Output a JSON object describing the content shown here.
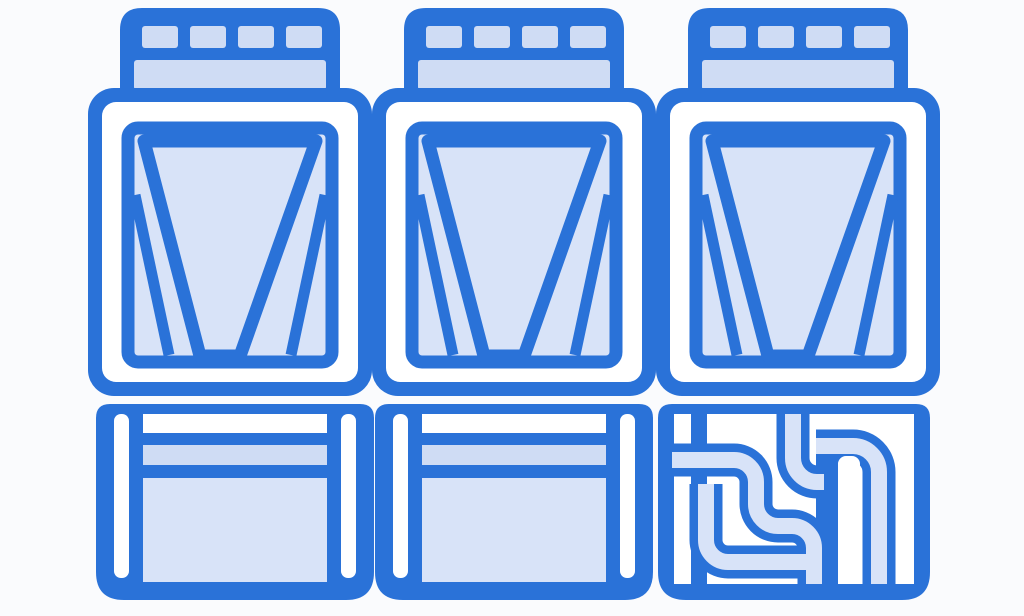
{
  "illustration": {
    "title": "Industrial air-cooled chiller units",
    "description": "Three blue line-art chiller modules with vented top caps, trapezoidal fan shrouds, louvered service bases, and a refrigerant pipe assembly in the base of the right unit",
    "background": "#fafbfd",
    "colors": {
      "outline": "#2a72d8",
      "fill_light": "#cfdcf4",
      "fill_lighter": "#d8e3f8",
      "white": "#ffffff"
    },
    "units": [
      {
        "id": "chiller-unit-1",
        "parts": [
          "vent-cap",
          "fan-panel",
          "service-base"
        ]
      },
      {
        "id": "chiller-unit-2",
        "parts": [
          "vent-cap",
          "fan-panel",
          "service-base"
        ]
      },
      {
        "id": "chiller-unit-3",
        "parts": [
          "vent-cap",
          "fan-panel",
          "pipe-base"
        ]
      }
    ]
  }
}
